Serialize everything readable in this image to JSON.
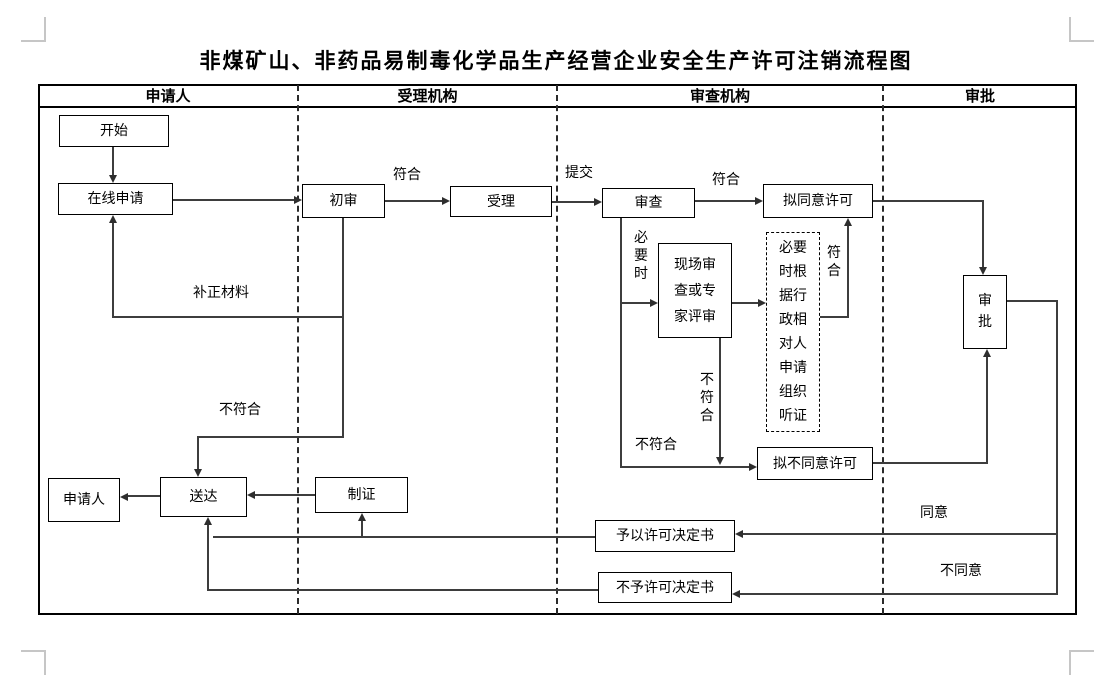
{
  "title": "非煤矿山、非药品易制毒化学品生产经营企业安全生产许可注销流程图",
  "columns": [
    "申请人",
    "受理机构",
    "审查机构",
    "审批"
  ],
  "nodes": {
    "start": "开始",
    "online_apply": "在线申请",
    "preliminary_review": "初审",
    "accept": "受理",
    "review": "审查",
    "propose_approve": "拟同意许可",
    "onsite_review": "现场审查或专家评审",
    "hearing": "必要时根据行政相对人申请组织听证",
    "propose_disapprove": "拟不同意许可",
    "approval": "审批",
    "applicant": "申请人",
    "deliver": "送达",
    "make_cert": "制证",
    "grant_decision": "予以许可决定书",
    "deny_decision": "不予许可决定书"
  },
  "edge_labels": {
    "conform1": "符合",
    "submit": "提交",
    "conform2": "符合",
    "when_necessary": "必要时",
    "conform3": "符合",
    "not_conform_vertical": "不符合",
    "not_conform_left": "不符合",
    "supplement_materials": "补正材料",
    "not_conform_mid": "不符合",
    "agree": "同意",
    "disagree": "不同意"
  },
  "colors": {
    "line": "#3d3d3d",
    "border": "#000000",
    "corner_mark": "#c6c6c6"
  }
}
